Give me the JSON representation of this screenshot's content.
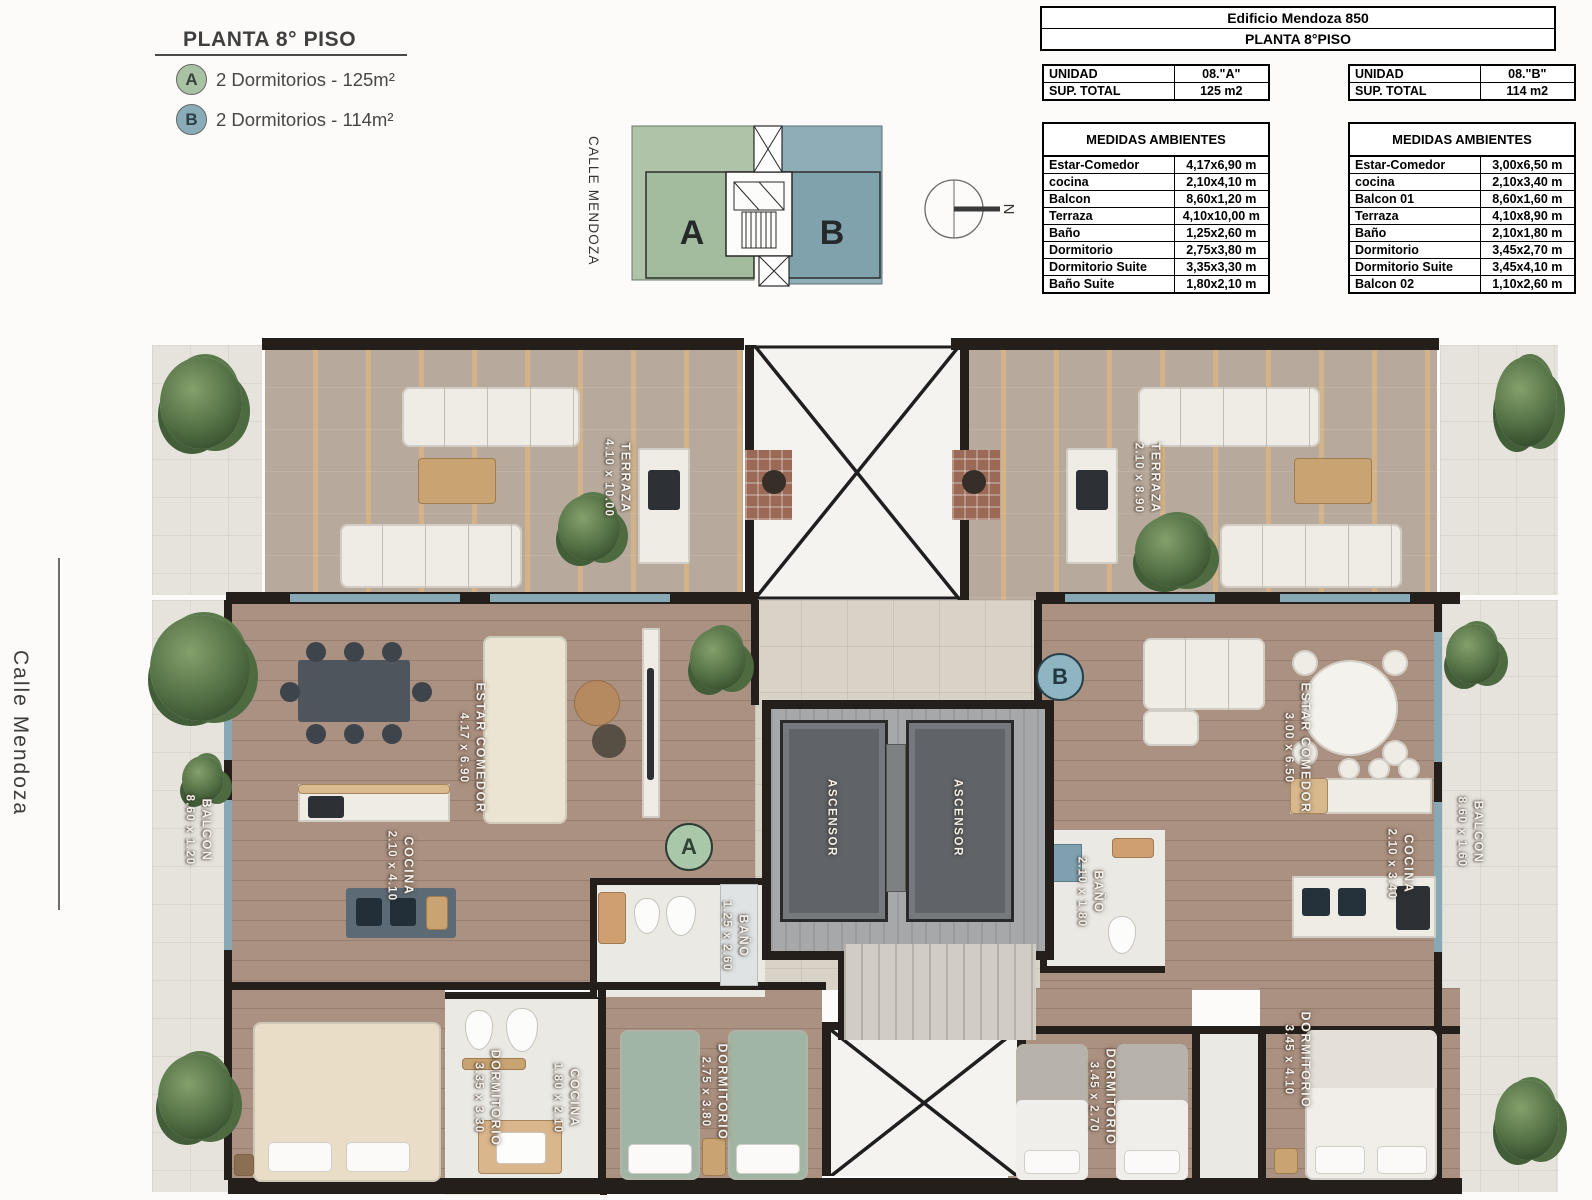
{
  "page": {
    "title": "PLANTA 8° PISO",
    "street_top": "CALLE MENDOZA",
    "street_left": "Calle Mendoza",
    "north": "N"
  },
  "legend": {
    "items": [
      {
        "badge": "A",
        "label": "2 Dormitorios - 125m²",
        "color": "#a9c2a4"
      },
      {
        "badge": "B",
        "label": "2 Dormitorios - 114m²",
        "color": "#8aacb8"
      }
    ]
  },
  "keyplan": {
    "a": "A",
    "b": "B"
  },
  "header_table": {
    "line1": "Edificio Mendoza 850",
    "line2": "PLANTA 8°PISO"
  },
  "unit_a": {
    "info": [
      [
        "UNIDAD",
        "08.\"A\""
      ],
      [
        "SUP. TOTAL",
        "125 m2"
      ]
    ],
    "medidas_title": "MEDIDAS AMBIENTES",
    "rows": [
      [
        "Estar-Comedor",
        "4,17x6,90 m"
      ],
      [
        "cocina",
        "2,10x4,10 m"
      ],
      [
        "Balcon",
        "8,60x1,20 m"
      ],
      [
        "Terraza",
        "4,10x10,00 m"
      ],
      [
        "Baño",
        "1,25x2,60 m"
      ],
      [
        "Dormitorio",
        "2,75x3,80 m"
      ],
      [
        "Dormitorio Suite",
        "3,35x3,30 m"
      ],
      [
        "Baño Suite",
        "1,80x2,10 m"
      ]
    ]
  },
  "unit_b": {
    "info": [
      [
        "UNIDAD",
        "08.\"B\""
      ],
      [
        "SUP. TOTAL",
        "114 m2"
      ]
    ],
    "medidas_title": "MEDIDAS AMBIENTES",
    "rows": [
      [
        "Estar-Comedor",
        "3,00x6,50 m"
      ],
      [
        "cocina",
        "2,10x3,40 m"
      ],
      [
        "Balcon 01",
        "8,60x1,60 m"
      ],
      [
        "Terraza",
        "4,10x8,90 m"
      ],
      [
        "Baño",
        "2,10x1,80 m"
      ],
      [
        "Dormitorio",
        "3,45x2,70 m"
      ],
      [
        "Dormitorio Suite",
        "3,45x4,10 m"
      ],
      [
        "Balcon 02",
        "1,10x2,60 m"
      ]
    ]
  },
  "plan": {
    "badge_a": "A",
    "badge_b": "B",
    "ascensor": "ASCENSOR",
    "terraza_a": {
      "name": "TERRAZA",
      "size": "4.10 x 10.00"
    },
    "terraza_b": {
      "name": "TERRAZA",
      "size": "2.10 x 8.90"
    },
    "estar_a": {
      "name": "ESTAR COMEDOR",
      "size": "4.17 x 6.90"
    },
    "estar_b": {
      "name": "ESTAR COMEDOR",
      "size": "3.00 x 6.50"
    },
    "cocina_a": {
      "name": "COCINA",
      "size": "2.10 x 4.10"
    },
    "cocina_b": {
      "name": "COCINA",
      "size": "2.10 x 3.40"
    },
    "balcon_a": {
      "name": "BALCON",
      "size": "8.60 x 1.20"
    },
    "balcon_b": {
      "name": "BALCON",
      "size": "8.60 x 1.60"
    },
    "bano_a": {
      "name": "BAÑO",
      "size": "1.25 x 2.60"
    },
    "bano_b": {
      "name": "BAÑO",
      "size": "2.10 x 1.80"
    },
    "dormitorio_suite_a": {
      "name": "DORMITORIO",
      "size": "3.35 x 3.30"
    },
    "bano_suite_a": {
      "name": "COCINA",
      "size": "1.80 x 2.10"
    },
    "dormitorio_a": {
      "name": "DORMITORIO",
      "size": "2.75 x 3.80"
    },
    "dormitorio_b": {
      "name": "DORMITORIO",
      "size": "3.45 x 2.70"
    },
    "dormitorio_suite_b": {
      "name": "DORMITORIO",
      "size": "3.45 x 4.10"
    }
  },
  "colors": {
    "wall": "#241f1a",
    "unit_a_fill": "#a9c2a4",
    "unit_b_fill": "#8aacb8"
  }
}
